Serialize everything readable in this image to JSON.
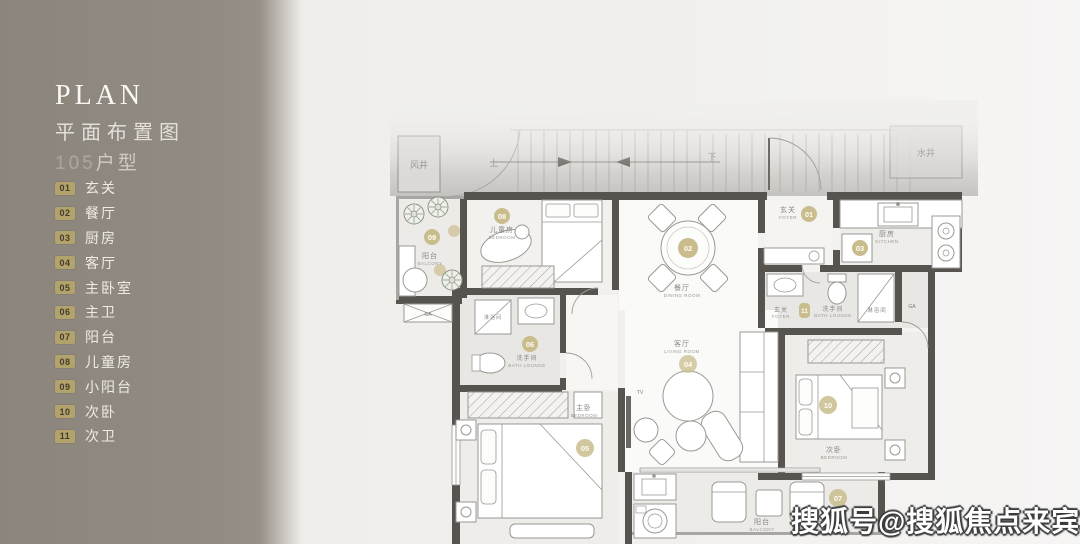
{
  "sidebar": {
    "title_en": "PLAN",
    "title_cn": "平面布置图",
    "unit_number": "105",
    "unit_suffix": "户型",
    "items": [
      {
        "num": "01",
        "label": "玄关"
      },
      {
        "num": "02",
        "label": "餐厅"
      },
      {
        "num": "03",
        "label": "厨房"
      },
      {
        "num": "04",
        "label": "客厅"
      },
      {
        "num": "05",
        "label": "主卧室"
      },
      {
        "num": "06",
        "label": "主卫"
      },
      {
        "num": "07",
        "label": "阳台"
      },
      {
        "num": "08",
        "label": "儿童房"
      },
      {
        "num": "09",
        "label": "小阳台"
      },
      {
        "num": "10",
        "label": "次卧"
      },
      {
        "num": "11",
        "label": "次卫"
      }
    ]
  },
  "plan": {
    "shaft_left": "风井",
    "shaft_right": "水井",
    "stair_up": "上",
    "stair_down": "下",
    "tv": "TV",
    "window_tag": "GA",
    "shower": "淋浴间",
    "rooms": {
      "entry": {
        "num": "01",
        "cn": "玄关",
        "en": "FOYER"
      },
      "dining": {
        "num": "02",
        "cn": "餐厅",
        "en": "DINING ROOM"
      },
      "kitchen": {
        "num": "03",
        "cn": "厨房",
        "en": "KITCHEN"
      },
      "living": {
        "num": "04",
        "cn": "客厅",
        "en": "LIVING ROOM"
      },
      "master": {
        "num": "05",
        "cn": "主卧",
        "en": "BEDROOM"
      },
      "master_bath": {
        "num": "06",
        "cn": "洗手间",
        "en": "BATH LOUNGE"
      },
      "balcony": {
        "num": "07",
        "cn": "阳台",
        "en": "BALCONY"
      },
      "kids": {
        "num": "08",
        "cn": "儿童房",
        "en": "BEDROOM"
      },
      "small_balcony": {
        "num": "09",
        "cn": "阳台",
        "en": "BALCONY"
      },
      "second": {
        "num": "10",
        "cn": "次卧",
        "en": "BEDROOM"
      },
      "second_bath": {
        "num": "11",
        "cn": "洗手间",
        "en": "BATH LOUNGE"
      }
    }
  },
  "watermark": "搜狐号@搜狐焦点来宾站",
  "colors": {
    "sidebar": "#8f887f",
    "wall": "#57544f",
    "badge_gold_sidebar": "#b2a36c",
    "badge_gold_plan": "#c9bd8e",
    "page_background": "#f0efed"
  }
}
